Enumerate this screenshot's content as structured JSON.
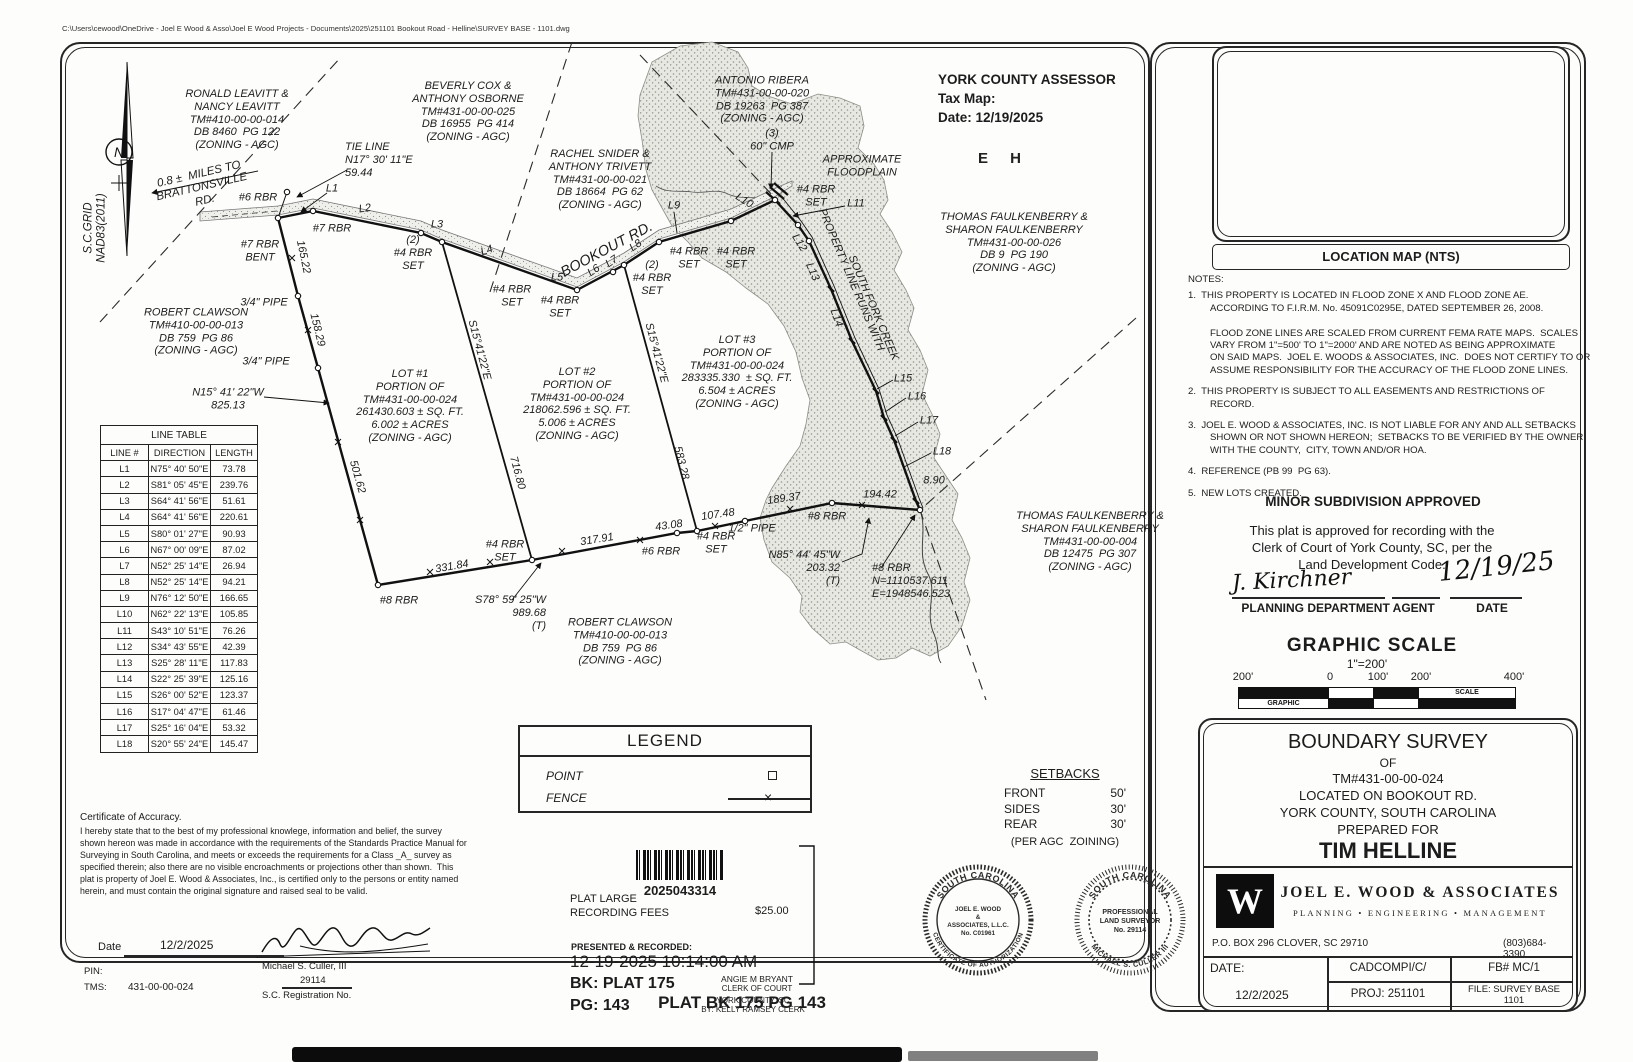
{
  "page": {
    "file_path": "C:\\Users\\cewood\\OneDrive - Joel E Wood & Asso\\Joel E Wood Projects - Documents\\2025\\251101 Bookout Road - Helline\\SURVEY BASE - 1101.dwg",
    "plat_footer": "PLAT BK 175 PG 143"
  },
  "assessor": {
    "title": "YORK COUNTY ASSESSOR",
    "tax_map_label": "Tax Map:",
    "date_line": "Date: 12/19/2025",
    "stamp_letters": "E H"
  },
  "location_map": {
    "caption": "LOCATION MAP (NTS)",
    "labels": [
      {
        "n": "map-road-mcconnells",
        "t": "McCONNELLS HWY.",
        "x": 1256,
        "y": 112,
        "r": -37,
        "s": 9.5
      },
      {
        "n": "map-road-bookout",
        "t": "BOOKOUT RD.",
        "x": 1333,
        "y": 96,
        "r": -21,
        "s": 9.5
      },
      {
        "n": "map-site-label",
        "t": "SITE",
        "x": 1398,
        "y": 114,
        "s": 13
      },
      {
        "n": "map-road-brattonsville",
        "t": "BRATTONSVILLE RD.",
        "x": 1320,
        "y": 185,
        "r": 55,
        "s": 9.5
      },
      {
        "n": "map-road-percival",
        "t": "PERCIVAL RD.",
        "x": 1509,
        "y": 198,
        "r": 62,
        "s": 9.5
      }
    ]
  },
  "notes": {
    "heading": "NOTES:",
    "items": [
      "1.  THIS PROPERTY IS LOCATED IN FLOOD ZONE X AND FLOOD ZONE AE.\nACCORDING TO F.I.R.M. No. 45091C0295E, DATED SEPTEMBER 26, 2008.\n\nFLOOD ZONE LINES ARE SCALED FROM CURRENT FEMA RATE MAPS.  SCALES\nVARY FROM 1\"=500' TO 1\"=2000' AND ARE NOTED AS BEING APPROXIMATE\nON SAID MAPS.  JOEL E. WOODS & ASSOCIATES, INC.  DOES NOT CERTIFY TO OR\nASSUME RESPONSIBILITY FOR THE ACCURACY OF THE FLOOD ZONE LINES.",
      "2.  THIS PROPERTY IS SUBJECT TO ALL EASEMENTS AND RESTRICTIONS OF\nRECORD.",
      "3.  JOEL E. WOOD & ASSOCIATES, INC. IS NOT LIABLE FOR ANY AND ALL SETBACKS\nSHOWN OR NOT SHOWN HEREON;  SETBACKS TO BE VERIFIED BY THE OWNER\nWITH THE COUNTY,  CITY, TOWN AND/OR HOA.",
      "4.  REFERENCE (PB 99  PG 63).",
      "5.  NEW LOTS CREATED."
    ]
  },
  "approval": {
    "title": "MINOR SUBDIVISION APPROVED",
    "body": "This plat is approved for recording with the\nClerk of Court of York County, SC, per the\nLand Development Code.",
    "signature": "J. Kirchner",
    "signature_date": "12/19/25",
    "agent_label": "PLANNING DEPARTMENT AGENT",
    "date_label": "DATE"
  },
  "graphic_scale": {
    "title": "GRAPHIC SCALE",
    "ratio": "1\"=200'",
    "ticks": [
      "200'",
      "0",
      "100'",
      "200'",
      "400'"
    ],
    "graphic_label": "GRAPHIC",
    "scale_label": "SCALE"
  },
  "title_block": {
    "l1": "BOUNDARY SURVEY",
    "l2": "OF",
    "l3": "TM#431-00-00-024",
    "l4": "LOCATED ON BOOKOUT RD.",
    "l5": "YORK COUNTY, SOUTH CAROLINA",
    "l6": "PREPARED FOR",
    "l7": "TIM HELLINE",
    "logo_letter": "W",
    "firm_name": "JOEL E. WOOD & ASSOCIATES",
    "tagline": "PLANNING  •  ENGINEERING  •  MANAGEMENT",
    "address": "P.O. BOX 296 CLOVER, SC 29710",
    "phone": "(803)684-3390",
    "date_label": "DATE:",
    "date": "12/2/2025",
    "cad": "CADCOMPI/C/",
    "fb": "FB# MC/1",
    "proj": "PROJ: 251101",
    "file": "FILE: SURVEY BASE\n1101"
  },
  "legend": {
    "title": "LEGEND",
    "point_label": "POINT",
    "fence_label": "FENCE"
  },
  "setbacks": {
    "title": "SETBACKS",
    "rows": [
      {
        "k": "FRONT",
        "v": "50'"
      },
      {
        "k": "SIDES",
        "v": "30'"
      },
      {
        "k": "REAR",
        "v": "30'"
      }
    ],
    "note": "(PER AGC  ZOINING)"
  },
  "recording": {
    "barcode_number": "2025043314",
    "fee_label": "PLAT LARGE\nRECORDING FEES",
    "fee_amount": "$25.00",
    "presented": "PRESENTED & RECORDED:",
    "datetime": "12-19-2025 10:14:00 AM",
    "book": "BK: PLAT 175",
    "page": "PG: 143",
    "clerk_name": "ANGIE M BRYANT",
    "clerk_title": "CLERK OF COURT",
    "county": "YORK COUNTY, SC",
    "recorded_by": "BY: KELLY RAMSEY CLERK"
  },
  "seals": {
    "auth": {
      "arc_top": "SOUTH CAROLINA",
      "arc_bottom": "CERTIFICATE OF AUTHORIZATION",
      "center": [
        "JOEL E. WOOD",
        "&",
        "ASSOCIATES, L.L.C.",
        "No. C01961"
      ]
    },
    "surveyor": {
      "arc_top": "SOUTH CAROLINA",
      "arc_bottom": "MICHAEL S. CULLER III",
      "center": [
        "PROFESSIONAL",
        "LAND SURVEYOR",
        "No. 29114"
      ]
    }
  },
  "certificate": {
    "heading": "Certificate of Accuracy.",
    "body": "I hereby state that to the best of my professional knowlege, information and belief, the survey\nshown hereon was made in accordance with the requirements of the Standards Practice Manual for\nSurveying in South Carolina, and meets or exceeds the requirements for a Class _A_ survey as\nspecified therein; also there are no visible encroachments or projections other than shown.  This\nplat is property of Joel E. Wood & Associates, Inc., is certified only to the persons or entity named\nherein, and must contain the original signature and raised seal to be valid.",
    "date_label": "Date",
    "date": "12/2/2025",
    "pin_label": "PIN:",
    "tms_label": "TMS:",
    "tms": "431-00-00-024",
    "surveyor_name": "Michael S. Culler, III",
    "reg_no": "29114",
    "reg_label": "S.C. Registration No."
  },
  "line_table": {
    "title": "LINE TABLE",
    "headers": [
      "LINE #",
      "DIRECTION",
      "LENGTH"
    ],
    "rows": [
      [
        "L1",
        "N75° 40' 50\"E",
        "73.78"
      ],
      [
        "L2",
        "S81° 05' 45\"E",
        "239.76"
      ],
      [
        "L3",
        "S64° 41' 56\"E",
        "51.61"
      ],
      [
        "L4",
        "S64° 41' 56\"E",
        "220.61"
      ],
      [
        "L5",
        "S80° 01' 27\"E",
        "90.93"
      ],
      [
        "L6",
        "N67° 00' 09\"E",
        "87.02"
      ],
      [
        "L7",
        "N52° 25' 14\"E",
        "26.94"
      ],
      [
        "L8",
        "N52° 25' 14\"E",
        "94.21"
      ],
      [
        "L9",
        "N76° 12' 50\"E",
        "166.65"
      ],
      [
        "L10",
        "N62° 22' 13\"E",
        "105.85"
      ],
      [
        "L11",
        "S43° 10' 51\"E",
        "76.26"
      ],
      [
        "L12",
        "S34° 43' 55\"E",
        "42.39"
      ],
      [
        "L13",
        "S25° 28' 11\"E",
        "117.83"
      ],
      [
        "L14",
        "S22° 25' 39\"E",
        "125.16"
      ],
      [
        "L15",
        "S26° 00' 52\"E",
        "123.37"
      ],
      [
        "L16",
        "S17° 04' 47\"E",
        "61.46"
      ],
      [
        "L17",
        "S25° 16' 04\"E",
        "53.32"
      ],
      [
        "L18",
        "S20° 55' 24\"E",
        "145.47"
      ]
    ]
  },
  "drawing": {
    "north_letter": "N",
    "labels": [
      {
        "n": "label-owner-leavitt",
        "t": "RONALD LEAVITT &\nNANCY LEAVITT\nTM#410-00-00-014\nDB 8460  PG 122\n(ZONING - AGC)",
        "x": 237,
        "y": 120
      },
      {
        "n": "label-owner-cox",
        "t": "BEVERLY COX &\nANTHONY OSBORNE\nTM#431-00-00-025\nDB 16955  PG 414\n(ZONING - AGC)",
        "x": 468,
        "y": 112
      },
      {
        "n": "label-owner-snider",
        "t": "RACHEL SNIDER &\nANTHONY TRIVETT\nTM#431-00-00-021\nDB 18664  PG 62\n(ZONING - AGC)",
        "x": 600,
        "y": 180
      },
      {
        "n": "label-owner-ribera",
        "t": "ANTONIO RIBERA\nTM#431-00-00-020\nDB 19263  PG 387\n(ZONING - AGC)",
        "x": 762,
        "y": 100
      },
      {
        "n": "label-owner-faulkenberry-026",
        "t": "THOMAS FAULKENBERRY &\nSHARON FAULKENBERRY\nTM#431-00-00-026\nDB 9  PG 190\n(ZONING - AGC)",
        "x": 1014,
        "y": 243
      },
      {
        "n": "label-owner-faulkenberry-004",
        "t": "THOMAS FAULKENBERRY &\nSHARON FAULKENBERRY\nTM#431-00-00-004\nDB 12475  PG 307\n(ZONING - AGC)",
        "x": 1090,
        "y": 542
      },
      {
        "n": "label-owner-clawson-west",
        "t": "ROBERT CLAWSON\nTM#410-00-00-013\nDB 759  PG 86\n(ZONING - AGC)",
        "x": 196,
        "y": 332
      },
      {
        "n": "label-owner-clawson-south",
        "t": "ROBERT CLAWSON\nTM#410-00-00-013\nDB 759  PG 86\n(ZONING - AGC)",
        "x": 620,
        "y": 642
      },
      {
        "n": "label-lot-1",
        "t": "LOT #1\nPORTION OF\nTM#431-00-00-024\n261430.603 ± SQ. FT.\n6.002 ± ACRES\n(ZONING - AGC)",
        "x": 410,
        "y": 406
      },
      {
        "n": "label-lot-2",
        "t": "LOT #2\nPORTION OF\nTM#431-00-00-024\n218062.596 ± SQ. FT.\n5.006 ± ACRES\n(ZONING - AGC)",
        "x": 577,
        "y": 404
      },
      {
        "n": "label-lot-3",
        "t": "LOT #3\nPORTION OF\nTM#431-00-00-024\n283335.330  ± SQ. FT.\n6.504 ± ACRES\n(ZONING - AGC)",
        "x": 737,
        "y": 372
      },
      {
        "n": "label-tie-line",
        "t": "TIE LINE\nN17° 30' 11\"E\n59.44",
        "x": 345,
        "y": 160,
        "a": "left"
      },
      {
        "n": "label-miles-note",
        "t": "0.8 ±  MILES TO\nBRATTONSVILLE\nRD.",
        "x": 202,
        "y": 188,
        "r": -13,
        "s": 11.5
      },
      {
        "n": "label-sc-grid",
        "t": "S.C.GRID\nNAD83(2011)",
        "x": 96,
        "y": 228,
        "r": -90,
        "s": 11.5
      },
      {
        "n": "label-mon-6rbr",
        "t": "#6 RBR",
        "x": 258,
        "y": 198
      },
      {
        "n": "label-mon-7rbr",
        "t": "#7 RBR",
        "x": 332,
        "y": 229
      },
      {
        "n": "label-mon-7rbr-bent",
        "t": "#7 RBR\nBENT",
        "x": 260,
        "y": 251
      },
      {
        "n": "label-l1",
        "t": "L1",
        "x": 332,
        "y": 189
      },
      {
        "n": "label-l2",
        "t": "L2",
        "x": 365,
        "y": 209,
        "r": -8
      },
      {
        "n": "label-l3",
        "t": "L3",
        "x": 437,
        "y": 225
      },
      {
        "n": "label-l4",
        "t": "L4",
        "x": 487,
        "y": 251,
        "r": -20
      },
      {
        "n": "label-l5",
        "t": "L5",
        "x": 557,
        "y": 278
      },
      {
        "n": "label-l6",
        "t": "L6",
        "x": 594,
        "y": 271,
        "r": -35
      },
      {
        "n": "label-l7",
        "t": "L7",
        "x": 612,
        "y": 262,
        "r": -35
      },
      {
        "n": "label-l8",
        "t": "L8",
        "x": 636,
        "y": 246,
        "r": -35
      },
      {
        "n": "label-l9",
        "t": "L9",
        "x": 674,
        "y": 206
      },
      {
        "n": "label-l10",
        "t": "L10",
        "x": 744,
        "y": 201,
        "r": 32
      },
      {
        "n": "label-l11",
        "t": "L11",
        "x": 856,
        "y": 204
      },
      {
        "n": "label-l12",
        "t": "L12",
        "x": 799,
        "y": 243,
        "r": 58
      },
      {
        "n": "label-l13",
        "t": "L13",
        "x": 812,
        "y": 272,
        "r": 66
      },
      {
        "n": "label-l14",
        "t": "L14",
        "x": 836,
        "y": 318,
        "r": 70
      },
      {
        "n": "label-l15",
        "t": "L15",
        "x": 903,
        "y": 379
      },
      {
        "n": "label-l16",
        "t": "L16",
        "x": 917,
        "y": 397
      },
      {
        "n": "label-l17",
        "t": "L17",
        "x": 929,
        "y": 421
      },
      {
        "n": "label-l18",
        "t": "L18",
        "x": 942,
        "y": 452
      },
      {
        "n": "label-dim-8-90",
        "t": "8.90",
        "x": 934,
        "y": 481
      },
      {
        "n": "label-dim-165-22",
        "t": "165.22",
        "x": 303,
        "y": 257,
        "r": 78
      },
      {
        "n": "label-dim-158-29",
        "t": "158.29",
        "x": 317,
        "y": 330,
        "r": 76
      },
      {
        "n": "label-dim-501-62",
        "t": "501.62",
        "x": 357,
        "y": 477,
        "r": 74
      },
      {
        "n": "label-mon-pipe34-a",
        "t": "3/4\" PIPE",
        "x": 264,
        "y": 303
      },
      {
        "n": "label-mon-pipe34-b",
        "t": "3/4\" PIPE",
        "x": 266,
        "y": 362
      },
      {
        "n": "label-dim-n15",
        "t": "N15° 41' 22\"W\n825.13",
        "x": 228,
        "y": 399
      },
      {
        "n": "label-mon-2-4rbr-set-a",
        "t": "(2)\n#4 RBR\nSET",
        "x": 413,
        "y": 253
      },
      {
        "n": "label-mon-4rbr-set-a",
        "t": "#4 RBR\nSET",
        "x": 512,
        "y": 296
      },
      {
        "n": "label-mon-4rbr-set-b",
        "t": "#4 RBR\nSET",
        "x": 560,
        "y": 307
      },
      {
        "n": "label-mon-2-4rbr-set-b",
        "t": "(2)\n#4 RBR\nSET",
        "x": 652,
        "y": 278
      },
      {
        "n": "label-mon-4rbr-set-c",
        "t": "#4 RBR\nSET",
        "x": 689,
        "y": 258
      },
      {
        "n": "label-mon-4rbr-set-d",
        "t": "#4 RBR\nSET",
        "x": 736,
        "y": 258
      },
      {
        "n": "label-mon-4rbr-set-e",
        "t": "#4 RBR\nSET",
        "x": 816,
        "y": 196
      },
      {
        "n": "label-cmp",
        "t": "(3)\n60\" CMP",
        "x": 772,
        "y": 140
      },
      {
        "n": "label-bookout-rd",
        "t": "BOOKOUT RD.",
        "x": 607,
        "y": 250,
        "r": -28,
        "s": 14.5
      },
      {
        "n": "label-floodplain",
        "t": "APPROXIMATE\nFLOODPLAIN",
        "x": 862,
        "y": 166
      },
      {
        "n": "label-property-line-1",
        "t": "PROPERTY LINE RUNS WITH",
        "x": 851,
        "y": 280,
        "r": 67
      },
      {
        "n": "label-property-line-2",
        "t": "SOUTH FORK CREEK",
        "x": 873,
        "y": 308,
        "r": 67
      },
      {
        "n": "label-s15-a",
        "t": "S15°41'22\"E",
        "x": 479,
        "y": 350,
        "r": 75
      },
      {
        "n": "label-dim-716-80",
        "t": "716.80",
        "x": 517,
        "y": 473,
        "r": 75
      },
      {
        "n": "label-s15-b",
        "t": "S15°41'22\"E",
        "x": 656,
        "y": 353,
        "r": 75
      },
      {
        "n": "label-dim-583-28",
        "t": "583.28",
        "x": 681,
        "y": 463,
        "r": 76
      },
      {
        "n": "label-dim-331-84",
        "t": "331.84",
        "x": 452,
        "y": 567,
        "r": -10
      },
      {
        "n": "label-dim-317-91",
        "t": "317.91",
        "x": 597,
        "y": 540,
        "r": -9
      },
      {
        "n": "label-dim-43-08",
        "t": "43.08",
        "x": 669,
        "y": 526,
        "r": -8
      },
      {
        "n": "label-dim-107-48",
        "t": "107.48",
        "x": 718,
        "y": 515,
        "r": -8
      },
      {
        "n": "label-dim-189-37",
        "t": "189.37",
        "x": 784,
        "y": 499,
        "r": -8
      },
      {
        "n": "label-dim-194-42",
        "t": "194.42",
        "x": 880,
        "y": 495
      },
      {
        "n": "label-mon-8rbr-a",
        "t": "#8 RBR",
        "x": 399,
        "y": 601
      },
      {
        "n": "label-mon-8rbr-b",
        "t": "#8 RBR",
        "x": 827,
        "y": 517
      },
      {
        "n": "label-mon-8rbr-ne",
        "t": "#8 RBR\nN=1110537.611\nE=1948546.523",
        "x": 872,
        "y": 581,
        "a": "left"
      },
      {
        "n": "label-mon-pipe12",
        "t": "1/2\" PIPE",
        "x": 752,
        "y": 529
      },
      {
        "n": "label-mon-6rbr-b",
        "t": "#6 RBR",
        "x": 661,
        "y": 552
      },
      {
        "n": "label-mon-4rbr-set-f",
        "t": "#4 RBR\nSET",
        "x": 505,
        "y": 551
      },
      {
        "n": "label-mon-4rbr-set-g",
        "t": "#4 RBR\nSET",
        "x": 716,
        "y": 543
      },
      {
        "n": "label-dim-s78",
        "t": "S78° 59' 25\"W\n989.68\n(T)",
        "x": 546,
        "y": 613,
        "a": "right"
      },
      {
        "n": "label-dim-n85",
        "t": "N85° 44' 45\"W\n203.32\n(T)",
        "x": 840,
        "y": 568,
        "a": "right"
      }
    ]
  }
}
